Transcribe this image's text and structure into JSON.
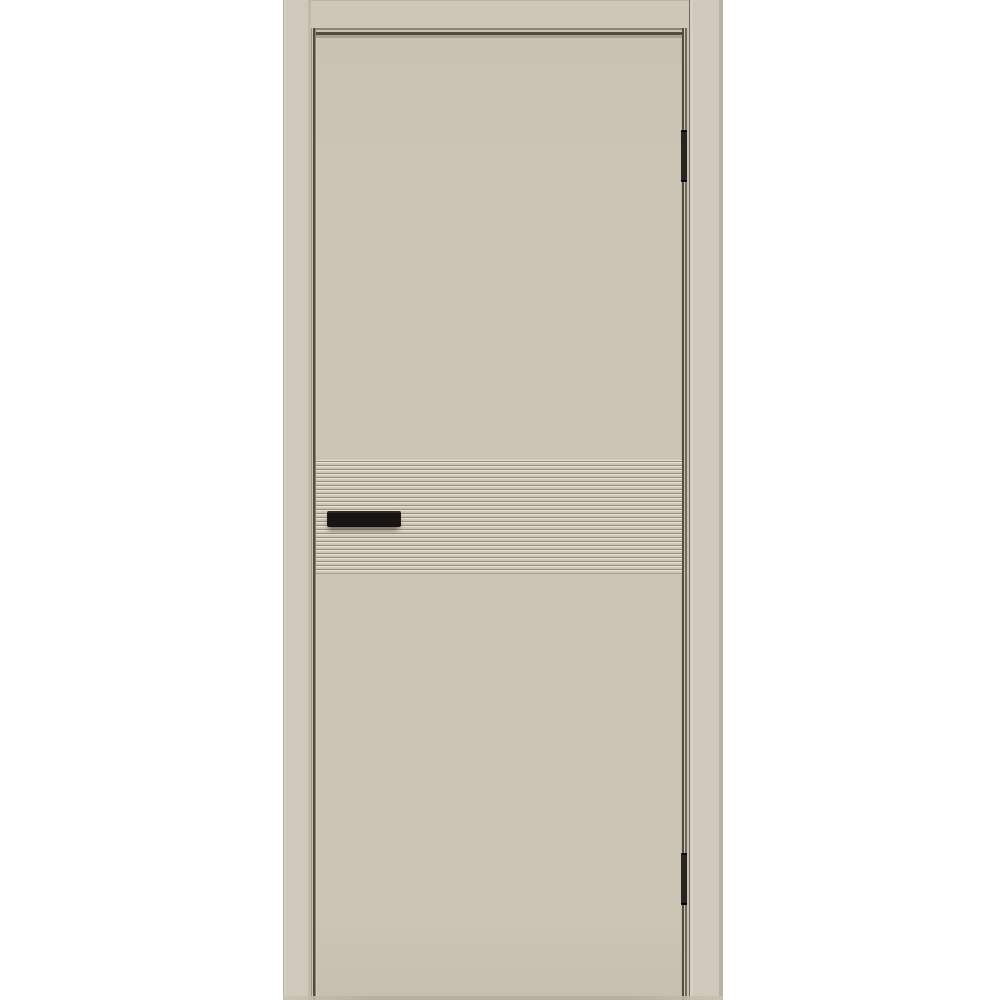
{
  "scene": {
    "type": "product-photo",
    "subject": "Closed interior door in a door frame, matte cashmere-beige finish, with a horizontal fluted groove band at handle height, a black rectangular flush pull handle on the left side of the leaf, and two black hinges on the right edge",
    "background_color": "#ffffff"
  },
  "colors": {
    "bg": "#ffffff",
    "casing": "#d0c9bb",
    "casing_light": "#cdc7b8",
    "leaf": "#cbc5b6",
    "seam_dark": "#514c3b",
    "seam_mid": "#8a8477",
    "seam_light": "#c9c2b3",
    "stripe_base": "#ccc6b7",
    "stripe_high": "#e9e3d4",
    "stripe_low": "#948d7d",
    "hardware": "#161514",
    "outer_edge": "#b9b2a4"
  },
  "door": {
    "parts": {
      "frame_left": "Left frame casing",
      "frame_right": "Right frame casing",
      "frame_head": "Head frame casing",
      "gap_top": "Top reveal gap",
      "gap_left": "Left reveal gap",
      "gap_right": "Right reveal gap",
      "leaf": "Door leaf",
      "stripe_band": "Horizontal fluted groove band",
      "handle": "Black flush pull handle",
      "hinge_top": "Top hinge",
      "hinge_bottom": "Bottom hinge",
      "floor_shadow": "Bottom edge shadow"
    },
    "stripe_band": {
      "groove_count": 28
    },
    "hinge_count": 2,
    "handle_side": "left",
    "hinge_side": "right"
  }
}
